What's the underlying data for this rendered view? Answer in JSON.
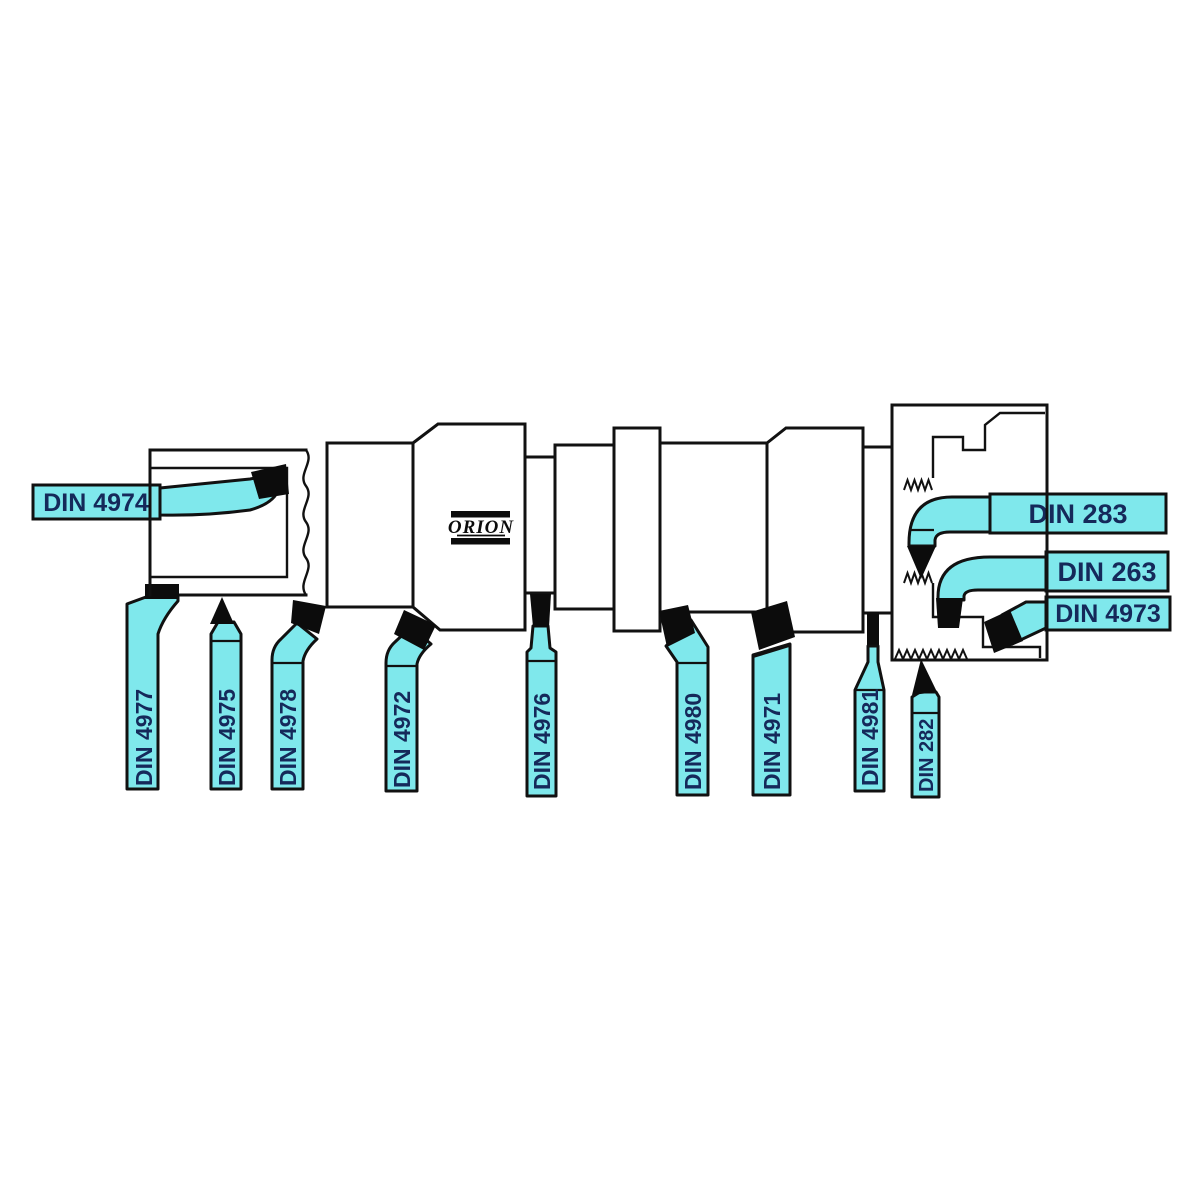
{
  "brand": {
    "logo_text": "ORION"
  },
  "colors": {
    "tool_fill": "#7fe8ec",
    "outline": "#111111",
    "tip_black": "#0c0c0c",
    "label_text": "#15295a",
    "background": "#ffffff"
  },
  "diagram": {
    "type": "lathe-turning-tools-application-diagram",
    "workpiece": "stepped shaft cross-section with bored left end, threaded right chuck section and ORION brand mark"
  },
  "tools": {
    "left": [
      {
        "id": "din-4974",
        "label": "DIN 4974"
      }
    ],
    "right": [
      {
        "id": "din-283",
        "label": "DIN 283"
      },
      {
        "id": "din-263",
        "label": "DIN 263"
      },
      {
        "id": "din-4973",
        "label": "DIN 4973"
      }
    ],
    "bottom": [
      {
        "id": "din-4977",
        "label": "DIN 4977"
      },
      {
        "id": "din-4975",
        "label": "DIN 4975"
      },
      {
        "id": "din-4978",
        "label": "DIN 4978"
      },
      {
        "id": "din-4972",
        "label": "DIN 4972"
      },
      {
        "id": "din-4976",
        "label": "DIN 4976"
      },
      {
        "id": "din-4980",
        "label": "DIN 4980"
      },
      {
        "id": "din-4971",
        "label": "DIN 4971"
      },
      {
        "id": "din-4981",
        "label": "DIN 4981"
      },
      {
        "id": "din-282",
        "label": "DIN 282"
      }
    ]
  }
}
